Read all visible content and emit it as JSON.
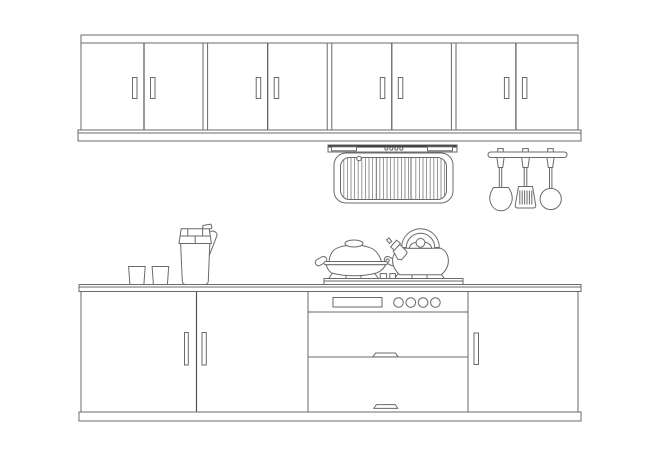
{
  "colors": {
    "background": "#ffffff",
    "line": "#6a6a6a",
    "line_dark": "#3e3e3e",
    "divider": "#555555",
    "grille_line": "#8c8c8c"
  },
  "scene": {
    "type": "kitchen-elevation-line-drawing",
    "upper_cabinets": {
      "units": 4,
      "doors": 8,
      "door_handles": 8
    },
    "range_hood": {
      "control_dots": 4,
      "side_vents": 2,
      "grille_sections": 3,
      "indicator_lights": 1
    },
    "utensil_rack": {
      "hooks": 3,
      "utensils": [
        "wok-spatula",
        "slotted-turner",
        "ladle"
      ]
    },
    "counter_items": {
      "cups": 2,
      "pitchers": 1
    },
    "cooktop": {
      "burners": 2,
      "igniter_blocks": 2,
      "cookware": [
        "covered-wok",
        "tea-kettle"
      ]
    },
    "oven": {
      "display_panels": 1,
      "knobs": 4,
      "door_panels": 2,
      "handle_tabs": 2
    },
    "base_cabinets": {
      "left_doors": 2,
      "right_doors": 1,
      "door_handles": 3
    }
  }
}
